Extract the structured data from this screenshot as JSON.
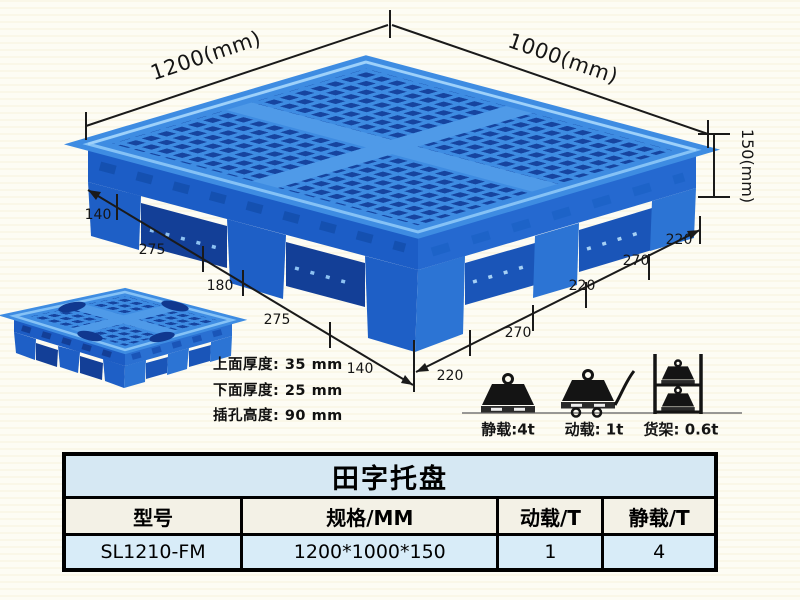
{
  "dimensions": {
    "top_left": "1200(mm)",
    "top_right": "1000(mm)",
    "height": "150(mm)",
    "sw_edge": [
      "140",
      "275",
      "180",
      "275",
      "140"
    ],
    "se_edge": [
      "220",
      "270",
      "220",
      "270",
      "220"
    ]
  },
  "specs": {
    "lines": [
      "上面厚度: 35 mm",
      "下面厚度: 25 mm",
      "插孔高度: 90 mm"
    ]
  },
  "loads": {
    "static_label": "静载:4t",
    "dynamic_label": "动载: 1t",
    "rack_label": "货架: 0.6t"
  },
  "table": {
    "title": "田字托盘",
    "headers": [
      "型号",
      "规格/MM",
      "动载/T",
      "静载/T"
    ],
    "row": [
      "SL1210-FM",
      "1200*1000*150",
      "1",
      "4"
    ]
  },
  "colors": {
    "pallet_blue": "#2b76d8",
    "pallet_dark_hole": "#16449f",
    "pallet_light_rib": "#3e8ce2",
    "dimension_line": "#1a1a1a",
    "table_title_bg": "#d6e8f3",
    "table_header_bg": "#f3f1e6",
    "table_row_bg": "#d8ecf8"
  }
}
